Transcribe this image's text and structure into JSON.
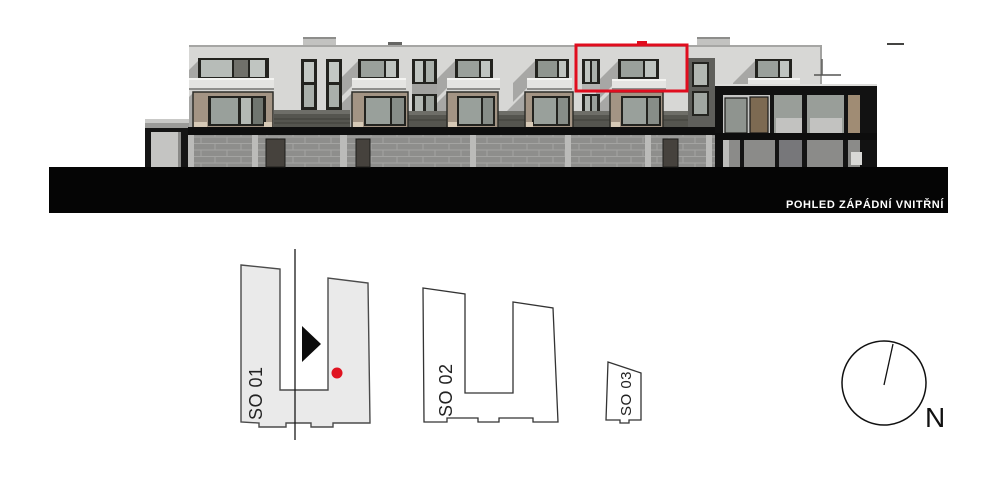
{
  "colors": {
    "highlight_red": "#e00d1e",
    "marker_dot_red": "#e01320",
    "facade_gray": "#d7d7d5",
    "ground_black": "#050505"
  },
  "elevation": {
    "caption": "POHLED ZÁPÁDNÍ VNITŘNÍ"
  },
  "site_plan": {
    "buildings": [
      {
        "label": "SO 01",
        "selected": true
      },
      {
        "label": "SO 02",
        "selected": false
      },
      {
        "label": "SO 03",
        "selected": false
      }
    ],
    "north_label": "N"
  }
}
